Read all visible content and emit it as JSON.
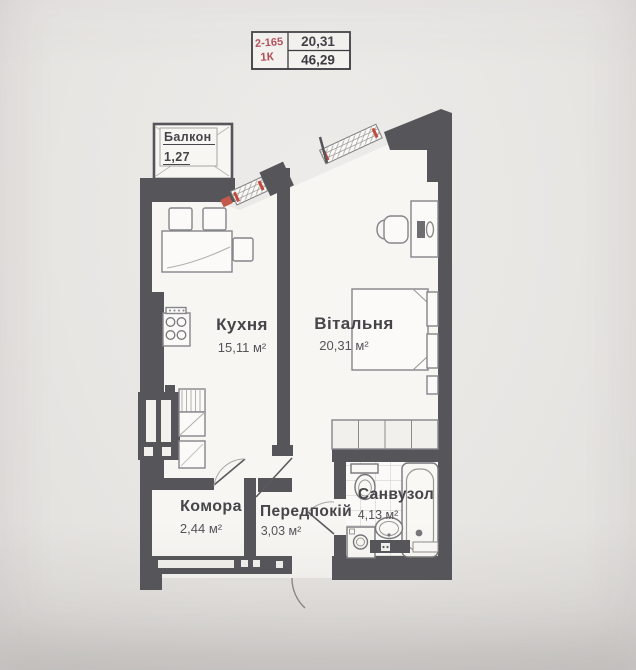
{
  "info_table": {
    "unit_id": "2-165",
    "unit_type": "1К",
    "area_living": "20,31",
    "area_total": "46,29"
  },
  "rooms": {
    "balcony": {
      "name": "Балкон",
      "area": "1,27"
    },
    "kitchen": {
      "name": "Кухня",
      "area": "15,11 м²"
    },
    "living_room": {
      "name": "Вітальня",
      "area": "20,31 м²"
    },
    "storage": {
      "name": "Комора",
      "area": "2,44 м²"
    },
    "hallway": {
      "name": "Передпокій",
      "area": "3,03 м²"
    },
    "bathroom": {
      "name": "Санвузол",
      "area": "4,13 м²"
    }
  },
  "colors": {
    "paper": "#e8e6e3",
    "wall": "#56565a",
    "floor": "#f7f6f3",
    "accent_red": "#b04e57",
    "window_tick": "#c24a3e"
  }
}
